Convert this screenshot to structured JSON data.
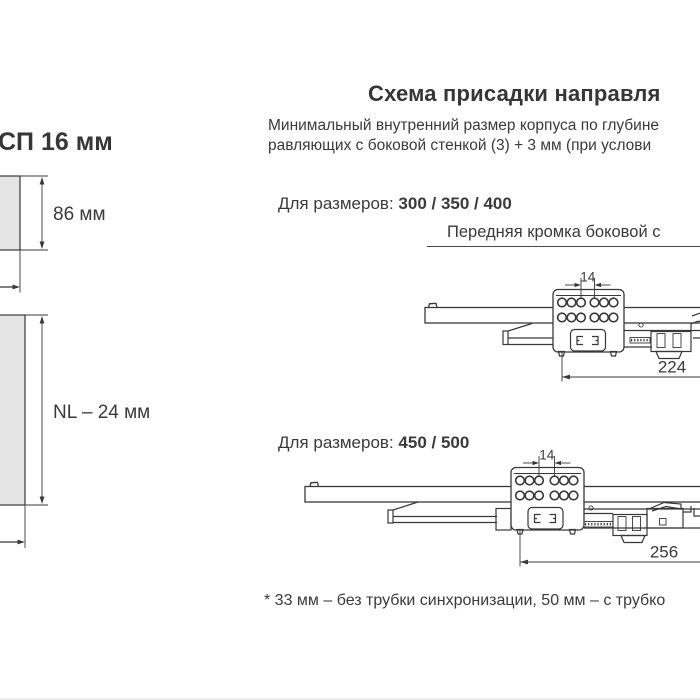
{
  "header": {
    "title": "Схема присадки направля",
    "intro_line1": "Минимальный внутренний размер корпуса по глубине",
    "intro_line2": "равляющих с боковой стенкой (3) + 3 мм (при услови"
  },
  "panel_diagram": {
    "material_label": "СП 16 мм",
    "front_section_height": "86 мм",
    "body_length": "NL – 24 мм"
  },
  "section_a": {
    "sizes_prefix": "Для размеров: ",
    "sizes": "300 / 350 / 400",
    "caption": "Передняя кромка боковой с",
    "hole_pitch": "14",
    "setback": "224"
  },
  "section_b": {
    "sizes_prefix": "Для размеров: ",
    "sizes": "450 / 500",
    "hole_pitch": "14",
    "setback": "256"
  },
  "footnote": "* 33 мм – без трубки синхронизации, 50 мм – с трубко",
  "colors": {
    "line": "#383838",
    "text": "#3a3a3a",
    "panel_fill": "#e4e4e4"
  }
}
